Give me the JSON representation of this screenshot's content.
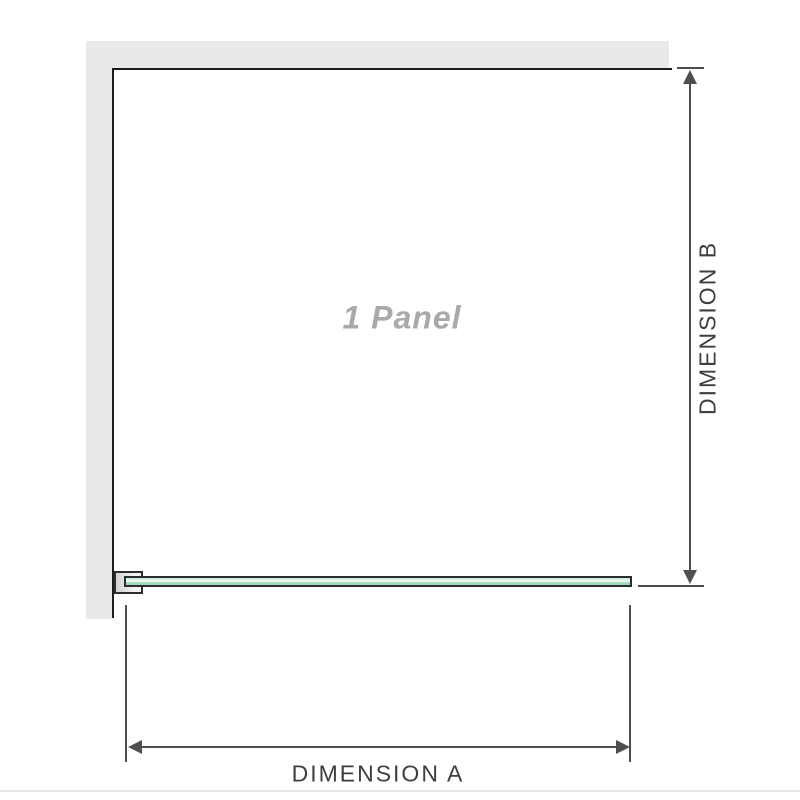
{
  "diagram": {
    "panel_label": "1 Panel",
    "dimensions": {
      "a_label": "DIMENSION A",
      "b_label": "DIMENSION B"
    }
  },
  "icons": {
    "arrow_up": "arrow-up-icon",
    "arrow_down": "arrow-down-icon",
    "arrow_left": "arrow-left-icon",
    "arrow_right": "arrow-right-icon"
  },
  "colors": {
    "wall": "#e9e9e9",
    "wall_edge": "#1c1c1c",
    "glass_border": "#2d2d2d",
    "glass_light": "#c9e8da",
    "glass_lighter": "#edf8f3",
    "glass_dark": "#9fd7b8",
    "bracket_dark": "#d2d2d2",
    "bracket_light": "#f5f5f5",
    "dimension_line": "#4f4f4f",
    "dimension_text": "#3e3e3e",
    "panel_text": "#a9a9a9",
    "divider": "#e4e4e4"
  }
}
